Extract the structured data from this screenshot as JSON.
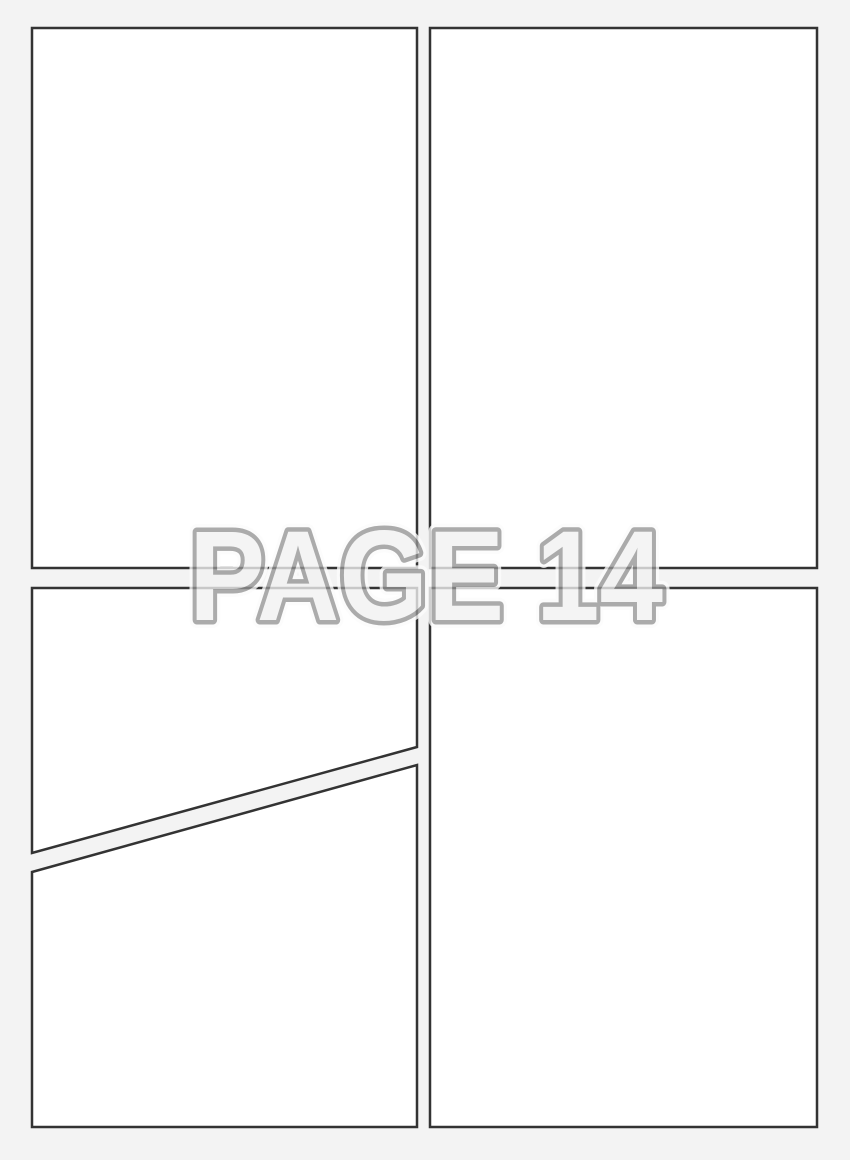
{
  "page_label": {
    "text": "PAGE 14"
  },
  "colors": {
    "background": "#f3f3f3",
    "panel_fill": "#ffffff",
    "panel_border": "#333333",
    "label_stroke": "#949494",
    "label_fill": "#f2f2f2",
    "label_halo": "#fcfcfc"
  },
  "panels": [
    {
      "name": "top-left"
    },
    {
      "name": "top-right"
    },
    {
      "name": "bottom-left-upper"
    },
    {
      "name": "bottom-left-lower"
    },
    {
      "name": "bottom-right"
    }
  ]
}
